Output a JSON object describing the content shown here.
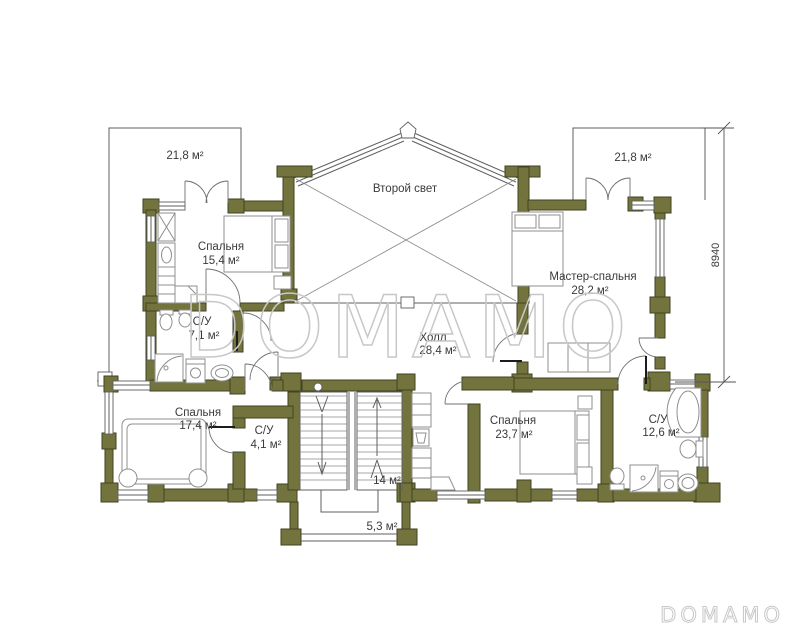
{
  "colors": {
    "wall": "#73743d",
    "wall_stroke": "#414221",
    "plan_line": "#5f5f5f",
    "furniture_line": "#8f8f8f",
    "door_line": "#707070",
    "dimension_line": "#555555",
    "label": "#3a3a3a",
    "watermark": "#c8c8c8",
    "background": "#ffffff"
  },
  "watermark": {
    "center": "DOMAMO",
    "corner": "DOMAMO"
  },
  "dimensions": {
    "right_side": "8940"
  },
  "rooms": {
    "balcony_top_left": {
      "area": "21,8 м²"
    },
    "second_light": {
      "name": "Второй свет"
    },
    "balcony_top_right": {
      "area": "21,8 м²"
    },
    "bedroom_1": {
      "name": "Спальня",
      "area": "15,4 м²"
    },
    "master_bedroom": {
      "name": "Мастер-спальня",
      "area": "28,2 м²"
    },
    "bathroom_1": {
      "name": "С/У",
      "area": "7,1 м²"
    },
    "hall": {
      "name": "Холл",
      "area": "28,4 м²"
    },
    "bedroom_2": {
      "name": "Спальня",
      "area": "17,4 м²"
    },
    "bathroom_2": {
      "name": "С/У",
      "area": "4,1 м²"
    },
    "bedroom_3": {
      "name": "Спальня",
      "area": "23,7 м²"
    },
    "bathroom_3": {
      "name": "С/У",
      "area": "12,6 м²"
    },
    "stairs": {
      "area": "14 м²"
    },
    "balcony_bottom": {
      "area": "5,3 м²"
    }
  }
}
